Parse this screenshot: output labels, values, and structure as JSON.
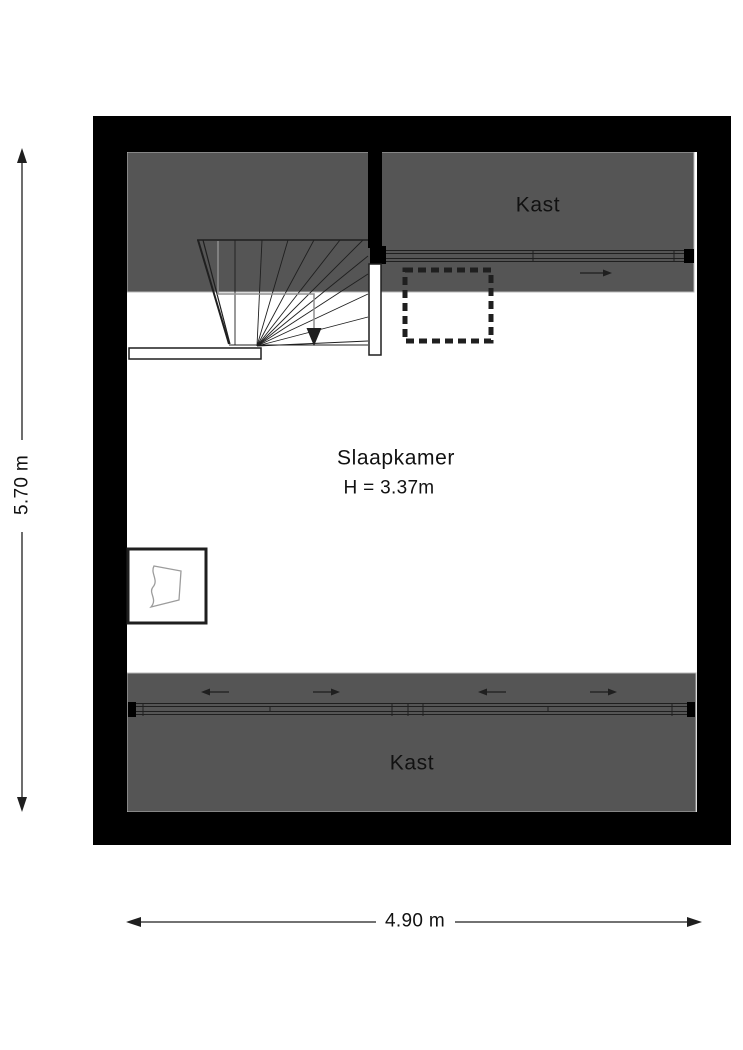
{
  "colors": {
    "background": "#ffffff",
    "wall": "#000000",
    "closet-fill": "#555555",
    "closet-border": "#b8b8b8",
    "line": "#1f1f1f",
    "walkline": "#8f8f8f",
    "window-detail": "#9c9c9c",
    "text": "#111111"
  },
  "floorplan": {
    "rooms": {
      "bedroom": {
        "label": "Slaapkamer",
        "ceiling_height": "H = 3.37m"
      },
      "closet_top": {
        "label": "Kast"
      },
      "closet_bottom": {
        "label": "Kast"
      }
    },
    "dimensions": {
      "total_height": "5.70 m",
      "total_width": "4.90 m"
    },
    "symbols": {
      "stair_arrow": "down",
      "closet_top_slide_arrow": "right",
      "closet_bottom_slide_arrows": [
        "left",
        "right",
        "left",
        "right"
      ]
    }
  }
}
